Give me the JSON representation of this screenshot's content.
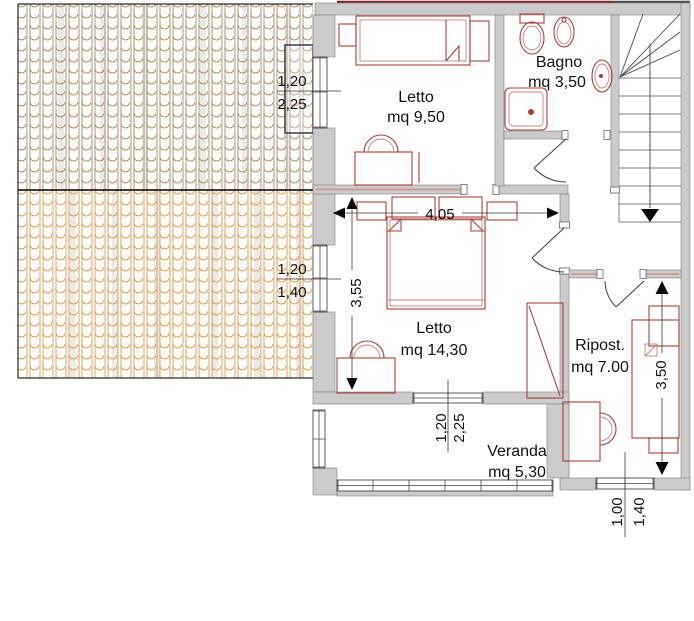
{
  "plan": {
    "type": "floor-plan",
    "rooms": [
      {
        "id": "letto-small",
        "name": "Letto",
        "area": "mq 9,50"
      },
      {
        "id": "bagno",
        "name": "Bagno",
        "area": "mq 3,50"
      },
      {
        "id": "letto-main",
        "name": "Letto",
        "area": "mq 14,30"
      },
      {
        "id": "ripostiglio",
        "name": "Ripost.",
        "area": "mq 7.00"
      },
      {
        "id": "veranda",
        "name": "Veranda",
        "area": "mq 5,30"
      }
    ],
    "dimensions": {
      "main_bedroom_width": "4,05",
      "main_bedroom_depth": "3,55",
      "ripost_depth": "3,50",
      "window_nw_top": "1,20",
      "window_nw_bottom": "2,25",
      "window_w_top": "1,20",
      "window_w_bottom": "1,40",
      "window_veranda_left": "1,20",
      "window_veranda_right": "2,25",
      "window_ripost_left": "1,00",
      "window_ripost_right": "1,40"
    },
    "colors": {
      "wall": "#cbcbcb",
      "furniture": "#a8403a",
      "roof_tile_dark": "#97784e",
      "roof_tile_light": "#cf8c33",
      "ridge_line": "#7e2222"
    }
  }
}
